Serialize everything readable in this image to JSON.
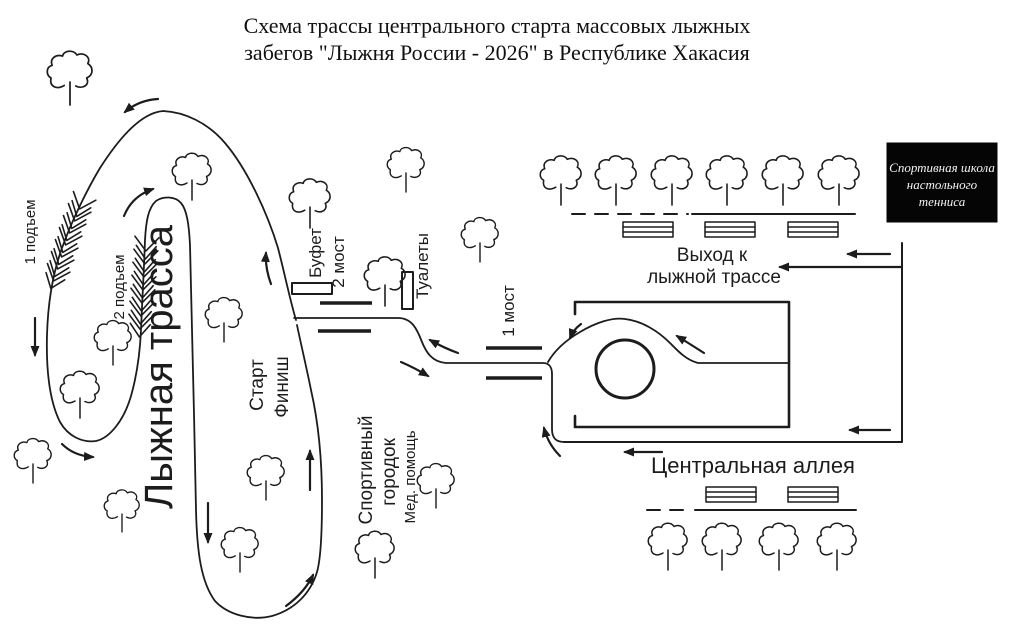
{
  "title": {
    "line1": "Схема трассы центрального старта массовых лыжных",
    "line2": "забегов \"Лыжня России - 2026\" в Республике Хакасия"
  },
  "trail_labels": {
    "climb_1": "1 подъем",
    "climb_2": "2 подъем",
    "ski_track": "Лыжная трасса",
    "start": "Старт",
    "finish": "Финиш"
  },
  "facility_labels": {
    "buffet": "Буфет",
    "bridge_2": "2 мост",
    "toilets": "Туалеты",
    "bridge_1": "1 мост",
    "sport_town_line1": "Спортивный",
    "sport_town_line2": "городок",
    "medical_aid": "Мед. помощь"
  },
  "park_labels": {
    "exit_line1": "Выход к",
    "exit_line2": "лыжной трассе",
    "central_alley": "Центральная аллея"
  },
  "school_sign": {
    "line1": "Спортивная школа",
    "line2": "настольного",
    "line3": "тенниса"
  },
  "colors": {
    "ink": "#1c1c1c",
    "background": "#ffffff",
    "school_box_bg": "#050505",
    "school_box_text": "#f5f5f5"
  }
}
